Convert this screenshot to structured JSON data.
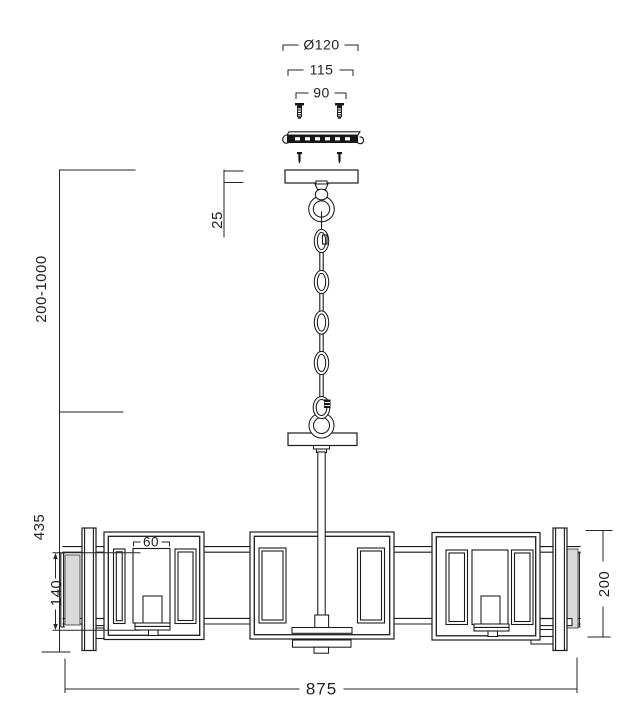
{
  "drawing": {
    "type": "chandelier installation dimension drawing",
    "colors": {
      "background": "#ffffff",
      "line": "#1b1b1b",
      "glass_shade": "#d9d9d9"
    }
  },
  "dimensions": {
    "canopy_diameter": "Ø120",
    "bracket_width": "115",
    "screw_spacing": "90",
    "canopy_height": "25",
    "suspension_range": "200-1000",
    "body_drop": "435",
    "candle_width": "60",
    "shade_height": "140",
    "frame_height": "200",
    "total_width": "875"
  }
}
